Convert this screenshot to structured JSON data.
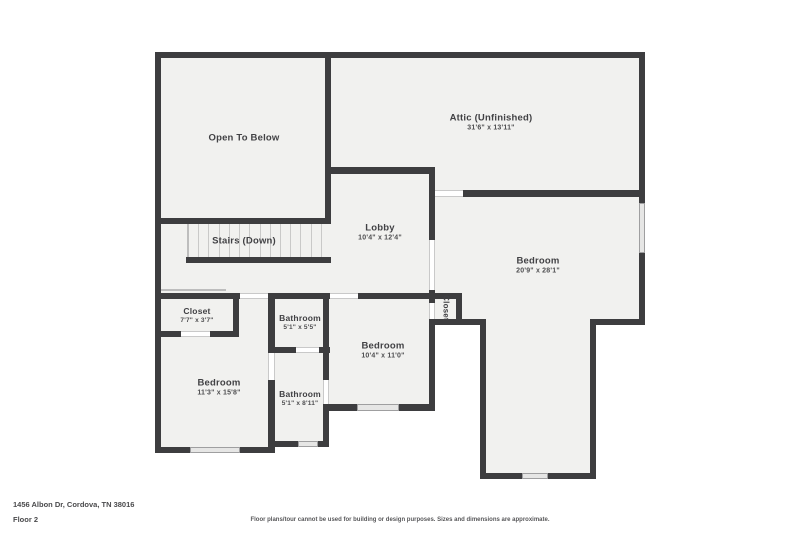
{
  "title": {
    "address": "1456 Albon Dr, Cordova, TN 38016",
    "floor": "Floor 2"
  },
  "disclaimer": "Floor plans/tour cannot be used for building or design purposes. Sizes and dimensions are approximate.",
  "stairs_treads": 13,
  "colors": {
    "wall": "#3d3d3f",
    "floor": "#f1f1ef",
    "window_fill": "#e6e6e5",
    "label_text": "#414144"
  },
  "rooms": {
    "open_to_below": {
      "name": "Open To Below",
      "dims": ""
    },
    "stairs": {
      "name": "Stairs (Down)",
      "dims": ""
    },
    "attic": {
      "name": "Attic (Unfinished)",
      "dims": "31'6\" x 13'11\""
    },
    "lobby": {
      "name": "Lobby",
      "dims": "10'4\" x 12'4\""
    },
    "bedroom_right": {
      "name": "Bedroom",
      "dims": "20'9\" x 28'1\""
    },
    "closet_left": {
      "name": "Closet",
      "dims": "7'7\" x 3'7\""
    },
    "bathroom_upper": {
      "name": "Bathroom",
      "dims": "5'1\" x 5'5\""
    },
    "bedroom_middle": {
      "name": "Bedroom",
      "dims": "10'4\" x 11'0\""
    },
    "closet_middle": {
      "name": "Closet",
      "dims": ""
    },
    "bedroom_left": {
      "name": "Bedroom",
      "dims": "11'3\" x 15'8\""
    },
    "bathroom_lower": {
      "name": "Bathroom",
      "dims": "5'1\" x 8'11\""
    }
  }
}
